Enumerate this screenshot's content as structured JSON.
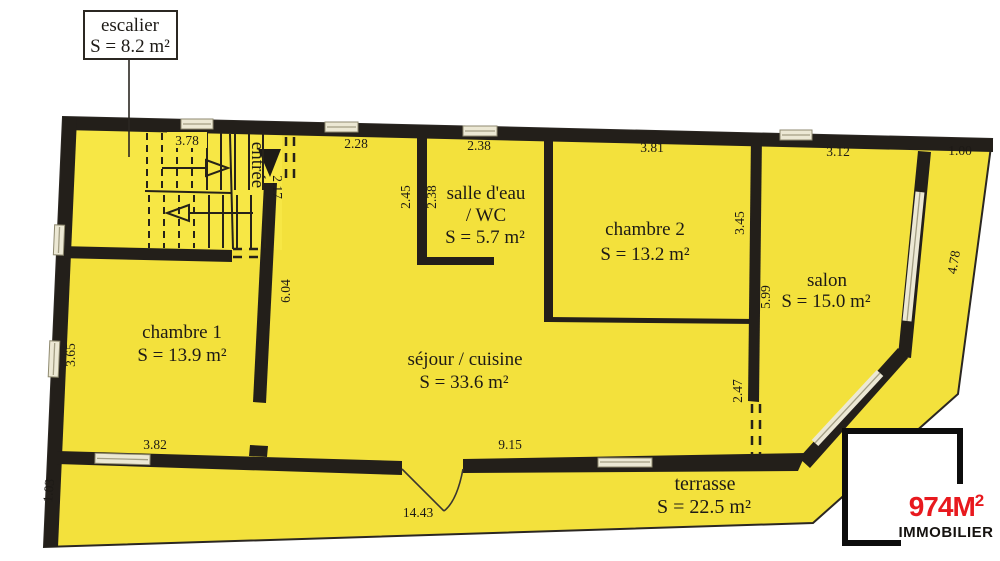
{
  "plan": {
    "callout": {
      "name": "escalier",
      "area": "S = 8.2 m²"
    },
    "rooms": {
      "entree": {
        "label": "entrée"
      },
      "salle_eau": {
        "line1": "salle d'eau",
        "line2": "/ WC",
        "area": "S = 5.7 m²"
      },
      "chambre2": {
        "label": "chambre 2",
        "area": "S = 13.2 m²"
      },
      "salon": {
        "label": "salon",
        "area": "S = 15.0 m²"
      },
      "chambre1": {
        "label": "chambre 1",
        "area": "S = 13.9 m²"
      },
      "sejour": {
        "label": "séjour / cuisine",
        "area": "S = 33.6 m²"
      },
      "terrasse": {
        "label": "terrasse",
        "area": "S = 22.5 m²"
      }
    },
    "dims": {
      "stairs_top": "3.78",
      "entree_top": "2.28",
      "salle_top": "2.38",
      "chambre2_top": "3.81",
      "salon_top": "3.12",
      "right_strip": "1.00",
      "entree_side": "2.17",
      "salle_left_outer": "2.45",
      "salle_left_inner": "2.38",
      "chambre1_divider": "6.04",
      "chambre2_side": "3.45",
      "salon_side": "5.99",
      "salon_right": "4.78",
      "chambre1_left": "3.65",
      "salon_opening": "2.47",
      "chambre1_bottom": "3.82",
      "sejour_bottom": "9.15",
      "terrasse_side": "1.03",
      "terrasse_bottom": "14.43"
    },
    "colors": {
      "floor": "#f3e13c",
      "stairs_floor": "#f7e745",
      "wall": "#231f1a",
      "window": "#ece8d4",
      "outline": "#2b2722"
    }
  },
  "logo": {
    "brand_main": "974M",
    "brand_sup": "2",
    "subtitle": "IMMOBILIER",
    "accent": "#e8191e"
  }
}
